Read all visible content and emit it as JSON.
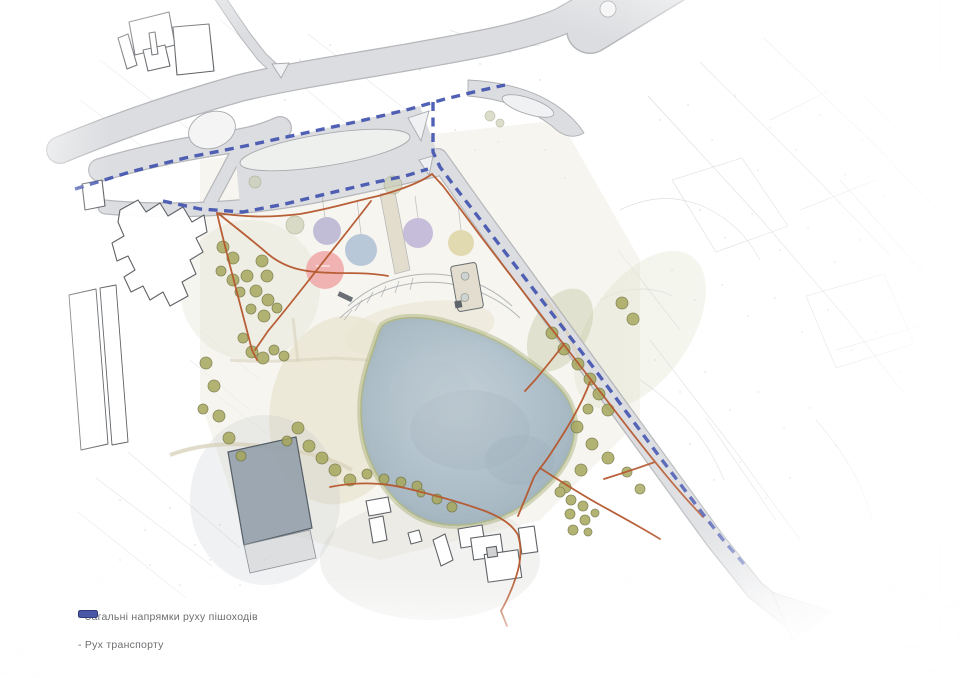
{
  "legend": {
    "items": [
      {
        "name": "pedestrian-flows",
        "label": "- Загальні напрямки руху пішоходів",
        "swatch_color": "#b4663c",
        "swatch_border": "#6f3a22"
      },
      {
        "name": "transport-flow",
        "label": "- Рух транспорту",
        "swatch_color": "#4a57a6",
        "swatch_border": "#2f3c7e"
      }
    ],
    "text_color": "#6d6e71"
  },
  "map": {
    "colors": {
      "background": "#ffffff",
      "road_fill": "#dcdde0",
      "road_edge": "#aeb0b3",
      "lake_water": "#a9bbc6",
      "shore_vegetation": "#99a465",
      "sand": "#eae4d2",
      "tree": "#a6a75c",
      "pedestrian_route": "#b5582e",
      "transport_route": "#3f51ae",
      "topo_sketch": "#b6b9be"
    },
    "zone_colors": [
      "#b5afd0",
      "#a9bdd2",
      "#b9b0d4",
      "#dcd2a0",
      "#efa3a3"
    ]
  }
}
